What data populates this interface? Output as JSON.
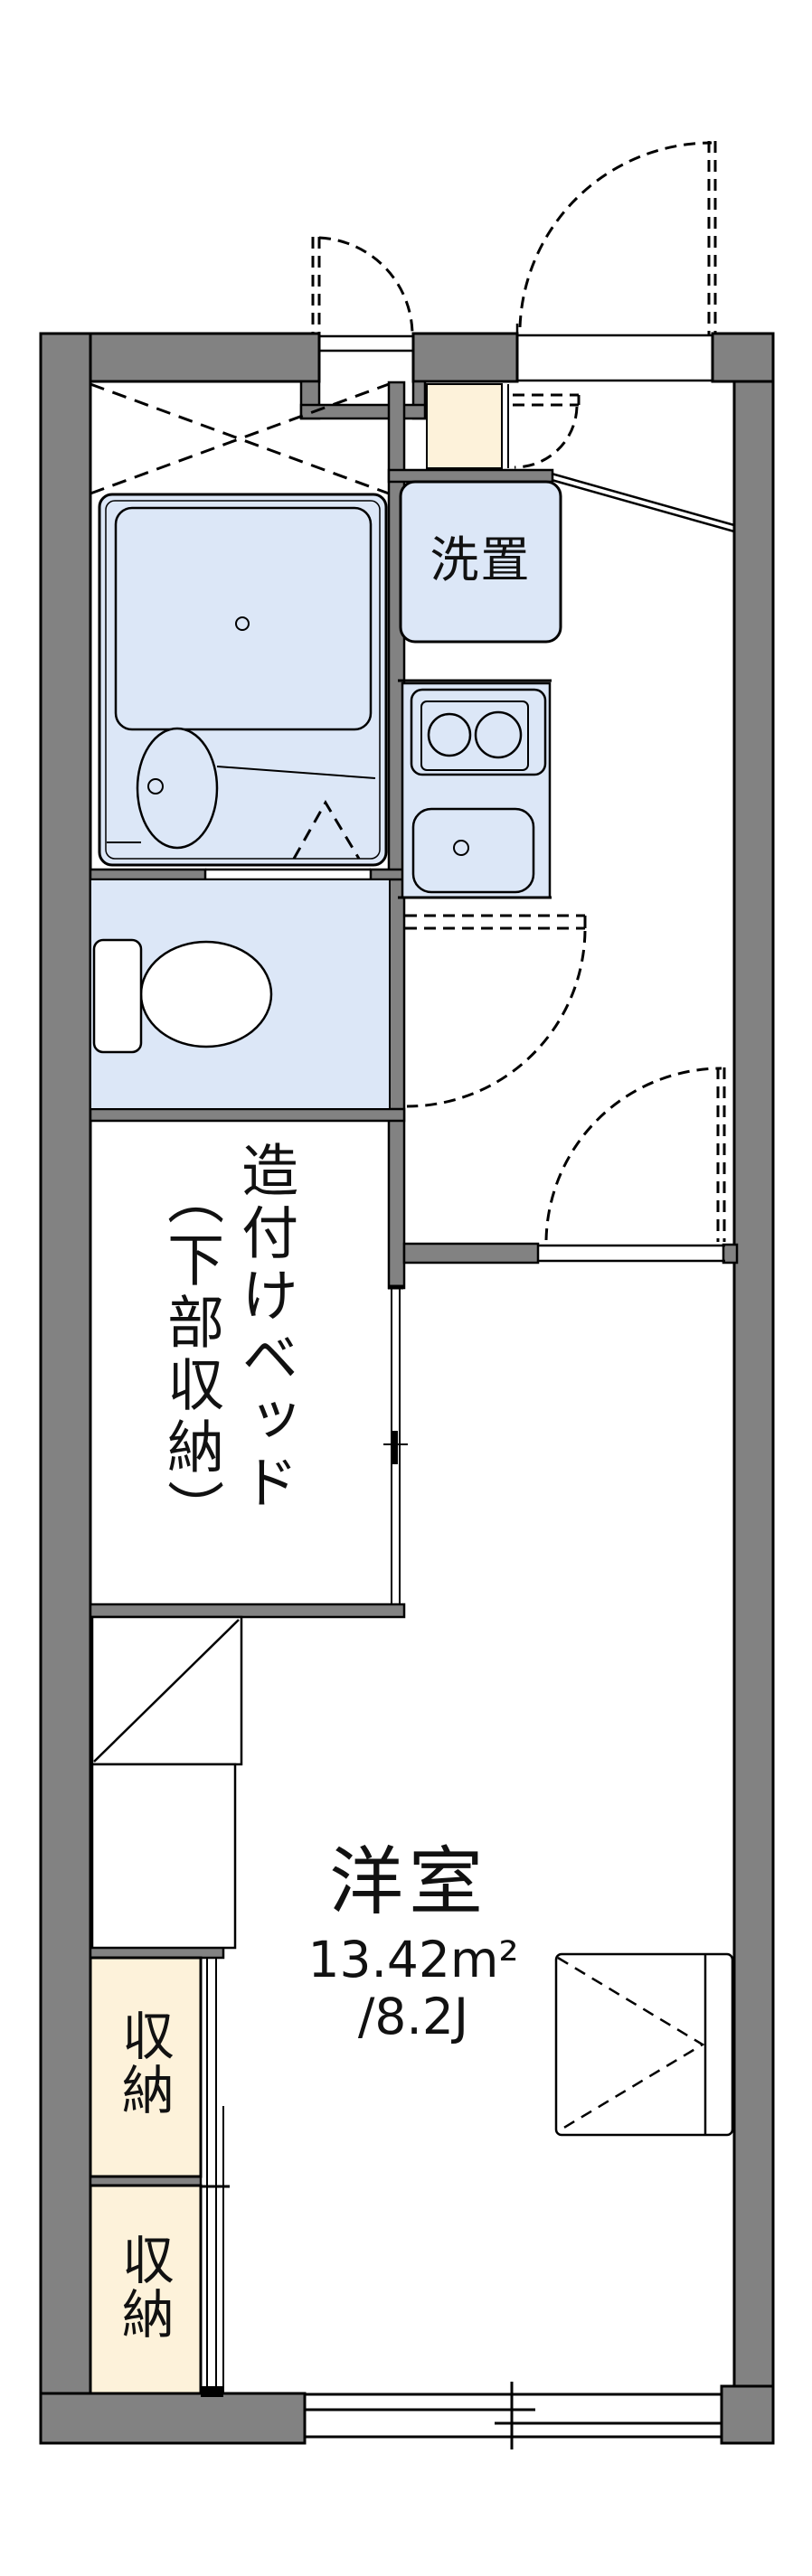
{
  "document_type": "japanese-apartment-floor-plan",
  "colors": {
    "bg": "#ffffff",
    "wall": "#828282",
    "line": "#111111",
    "fixture-blue": "#dce7f7",
    "storage-cream": "#fdf2da"
  },
  "labels": {
    "laundry": "洗置",
    "bed_column_right": "造付けベッド",
    "bed_column_left": "（下部収納）",
    "room_name": "洋室",
    "room_area_sqm": "13.42m²",
    "room_area_tatami": "/8.2J",
    "storage_upper": "収納",
    "storage_lower": "収納"
  },
  "rooms": {
    "western_room": {
      "name": "洋室",
      "area_m2": "13.42m²",
      "area_tatami": "/8.2J"
    },
    "built_in_bed": {
      "name": "造付けベッド（下部収納）"
    },
    "laundry_space": {
      "name": "洗置"
    },
    "storage_count": 2
  }
}
